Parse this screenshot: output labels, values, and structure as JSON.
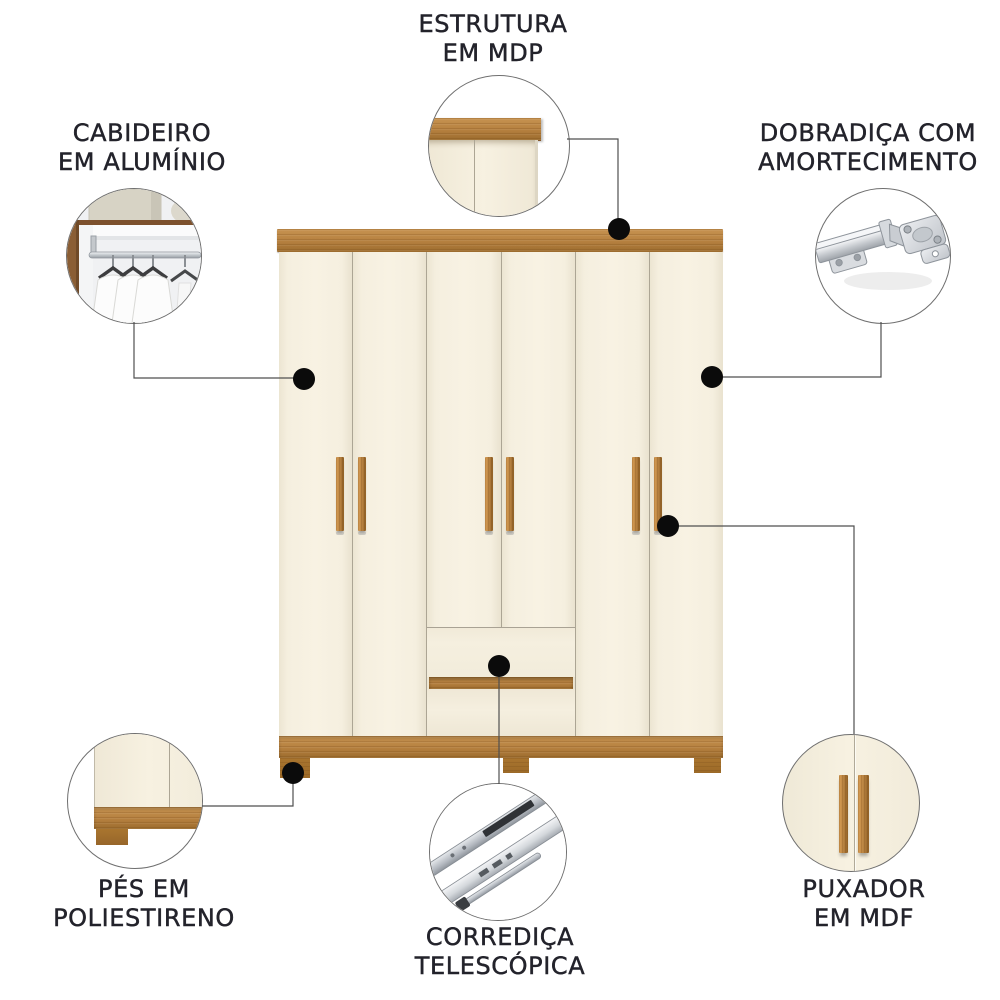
{
  "callouts": {
    "estrutura": {
      "line1": "ESTRUTURA",
      "line2": "EM MDP"
    },
    "cabideiro": {
      "line1": "CABIDEIRO",
      "line2": "EM ALUMÍNIO"
    },
    "dobradica": {
      "line1": "DOBRADIÇA COM",
      "line2": "AMORTECIMENTO"
    },
    "pes": {
      "line1": "PÉS EM",
      "line2": "POLIESTIRENO"
    },
    "corredica": {
      "line1": "CORREDIÇA",
      "line2": "TELESCÓPICA"
    },
    "puxador": {
      "line1": "PUXADOR",
      "line2": "EM MDF"
    }
  },
  "colors": {
    "wood": "#b5803f",
    "wood_lt": "#c79351",
    "wood_dark": "#9c6c2e",
    "cream": "#f5efdf",
    "text": "#23232b",
    "dot": "#0b0b0b",
    "line": "#4f4f4f",
    "metal": "#c7cbd0",
    "bg": "#ffffff"
  }
}
